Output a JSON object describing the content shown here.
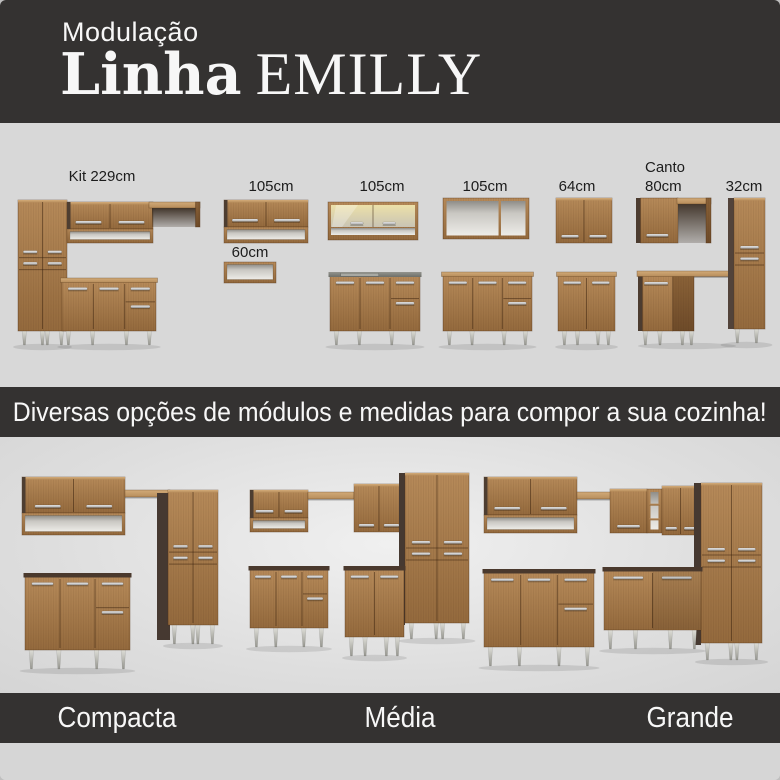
{
  "header": {
    "kicker": "Modulação",
    "brand": "Linha",
    "line": "EMILLY"
  },
  "modules": {
    "labels": [
      "Kit 229cm",
      "105cm",
      "60cm",
      "105cm",
      "105cm",
      "64cm",
      "Canto",
      "80cm",
      "32cm"
    ]
  },
  "banner": {
    "text": "Diversas opções de módulos e medidas para compor a sua cozinha!"
  },
  "options": [
    {
      "name": "Compacta"
    },
    {
      "name": "Média"
    },
    {
      "name": "Grande"
    }
  ],
  "colors": {
    "header_bg": "#343231",
    "section_bg": "#d8d8d8",
    "banner_bg": "#343231",
    "strip_bg": "#d6d6d6",
    "text_light": "#f7f7f7",
    "text_dark": "#1c1c1c",
    "wood": "#a87a4c",
    "wood_dark": "#6f4f2e",
    "panel_dark": "#493a30",
    "metal": "#c9c9c9"
  }
}
